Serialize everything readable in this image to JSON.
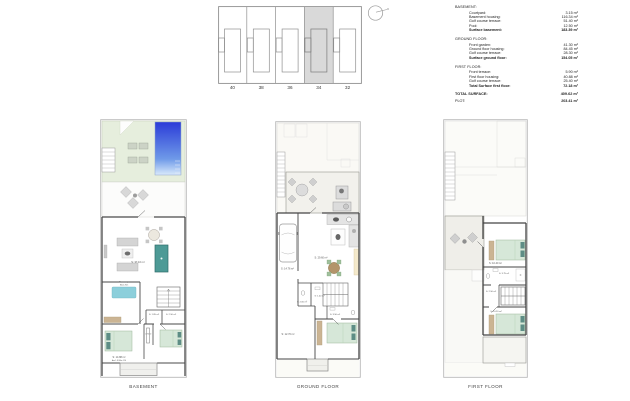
{
  "site_plan": {
    "plots": [
      "40",
      "38",
      "36",
      "34",
      "32"
    ],
    "highlighted_plot": "34"
  },
  "area_table": {
    "sections": [
      {
        "heading": "BASEMENT:",
        "rows": [
          {
            "label": "Courtyard:",
            "value": "3.15 m²"
          },
          {
            "label": "Basement housing:",
            "value": "116.34 m²"
          },
          {
            "label": "Golf course terrace:",
            "value": "51.40 m²"
          },
          {
            "label": "Pool:",
            "value": "12.50 m²"
          }
        ],
        "total": {
          "label": "Surface basement:",
          "value": "183.39 m²"
        }
      },
      {
        "heading": "GROUND FLOOR:",
        "rows": [
          {
            "label": "Front garden:",
            "value": "41.30 m²"
          },
          {
            "label": "Ground floor housing:",
            "value": "84.45 m²"
          },
          {
            "label": "Golf course terrace:",
            "value": "28.30 m²"
          }
        ],
        "total": {
          "label": "Surface ground floor:",
          "value": "154.05 m²"
        }
      },
      {
        "heading": "FIRST FLOOR:",
        "rows": [
          {
            "label": "Front terrace:",
            "value": "5.90 m²"
          },
          {
            "label": "First floor housing:",
            "value": "40.88 m²"
          },
          {
            "label": "Golf course terrace:",
            "value": "25.40 m²"
          }
        ],
        "total": {
          "label": "Total Surface first floor:",
          "value": "72.18 m²"
        }
      }
    ],
    "grand_total": {
      "label": "TOTAL SURFACE:",
      "value": "409.62 m²"
    },
    "plot": {
      "label": "PLOT:",
      "value": "203.41 m²"
    }
  },
  "plans": {
    "basement": {
      "label": "BASEMENT",
      "rooms": {
        "living": "S: 37.10 m²",
        "storage_line1": "Almacenaje",
        "storage_line2": "80x1.70m",
        "wc": "S: 1.85 m²",
        "bathroom": "S: 2.50 m²",
        "corridor": "0.75 m²",
        "bedroom_main": "S: 14.88 m²",
        "bedroom_main_note": "Arm 1.50 Max 1.90"
      }
    },
    "ground": {
      "label": "GROUND FLOOR",
      "rooms": {
        "garage": "S: 14.76 m²",
        "kitchen_living": "S: 29.60 m²",
        "wc": "S: 1.40 m²",
        "hall": "S: 2.65 m²",
        "bathroom": "S: 3.50 m²",
        "bedroom": "S: 12.70 m²"
      }
    },
    "first": {
      "label": "FIRST FLOOR",
      "rooms": {
        "bedroom_back": "S: 10.40 m²",
        "bathroom": "S: 3.75 m²",
        "landing": "S: 2.50 m²",
        "bedroom_front": "S: 10.20 m²"
      }
    }
  },
  "colors": {
    "pool_deep": "#2b3cd8",
    "pool_shallow": "#d9e9fb",
    "lawn": "#e6eedd",
    "pool_table": "#4d9a96",
    "rug": "#8ccfdb",
    "bed": "#d6e7d8",
    "pillow": "#5d8d85",
    "wood": "#cbb493",
    "cabinet": "#f4e9cb",
    "table_wood": "#b3946a",
    "highlight": "#d9d9d9"
  }
}
